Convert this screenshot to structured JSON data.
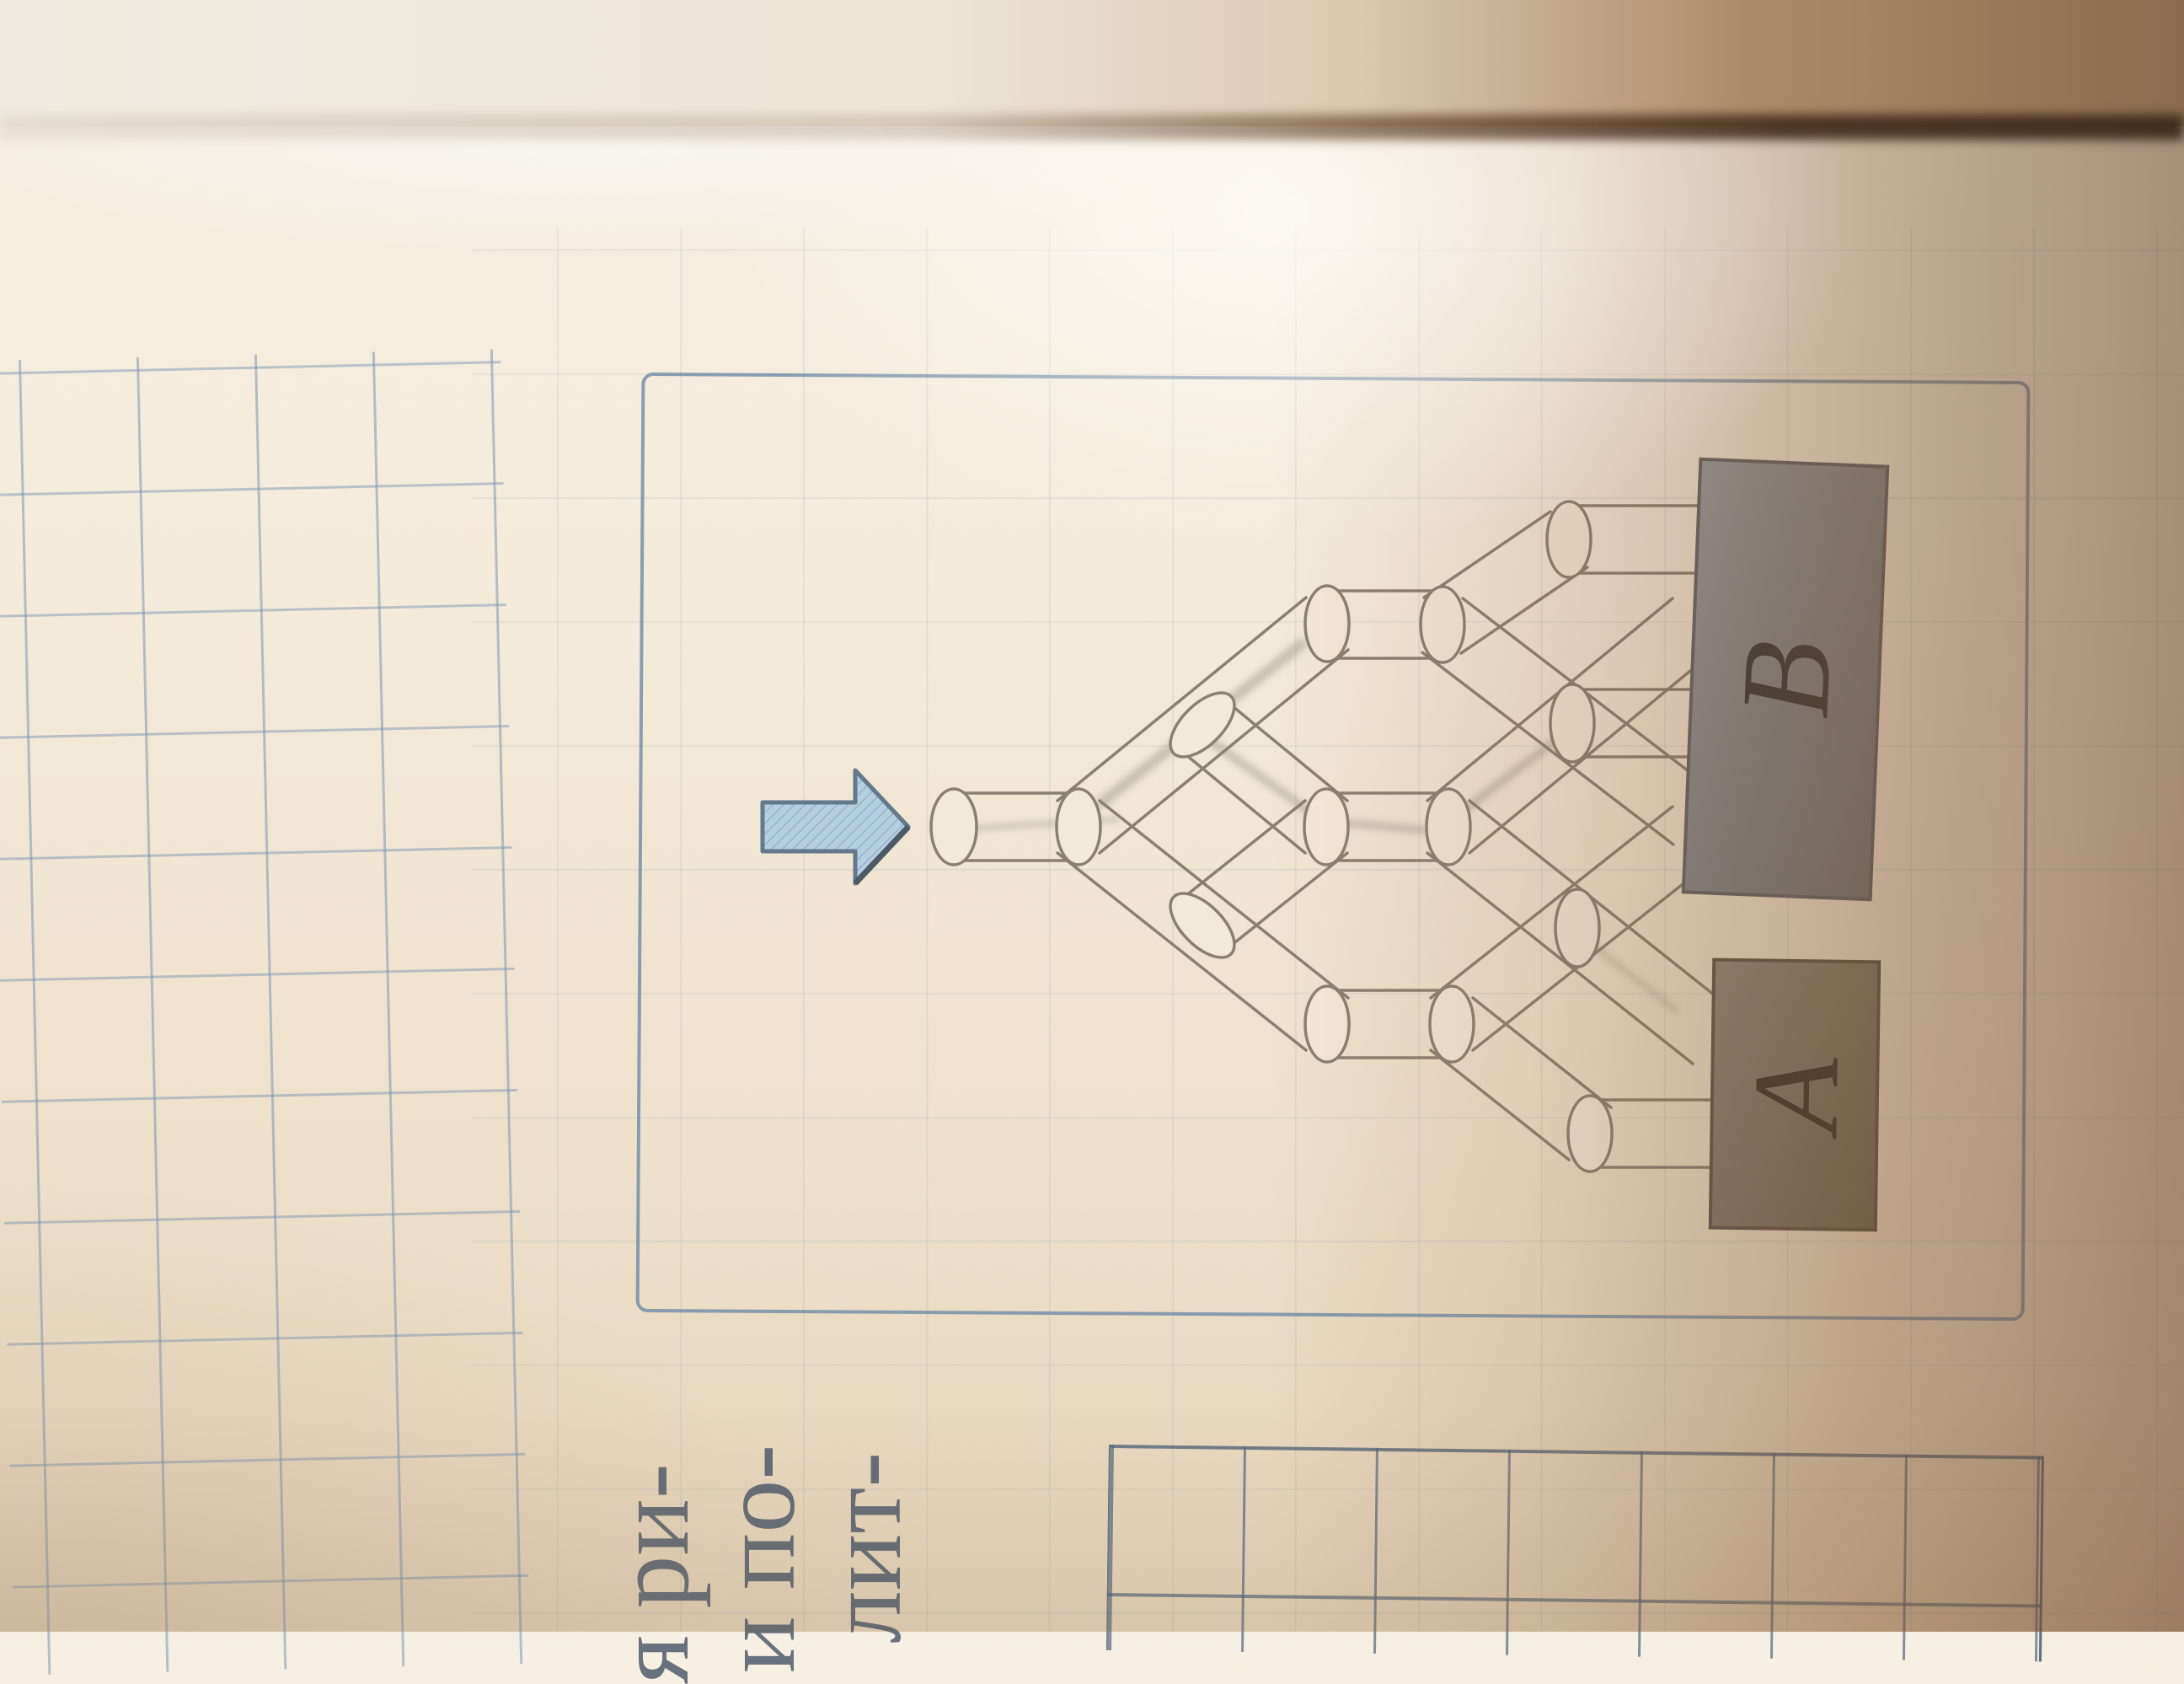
{
  "diagram": {
    "arrow_icon": "block-arrow-right",
    "container_labels": {
      "a": "A",
      "b": "B"
    }
  },
  "page_text": {
    "fragments": [
      "я ри-",
      "и по-",
      "лит-"
    ]
  },
  "colors": {
    "paper": "#f3e9d7",
    "frame_blue": "#748fa9",
    "grid_blue": "#7a95b4",
    "pipe_stroke": "#8a7f73",
    "arrow_fill": "#b6cfe0",
    "arrow_stroke": "#63788a",
    "box_b_fill": "#868c94",
    "box_a_fill": "#867e70",
    "letter_color": "#33363b",
    "shadow_brown": "#6b4226"
  }
}
